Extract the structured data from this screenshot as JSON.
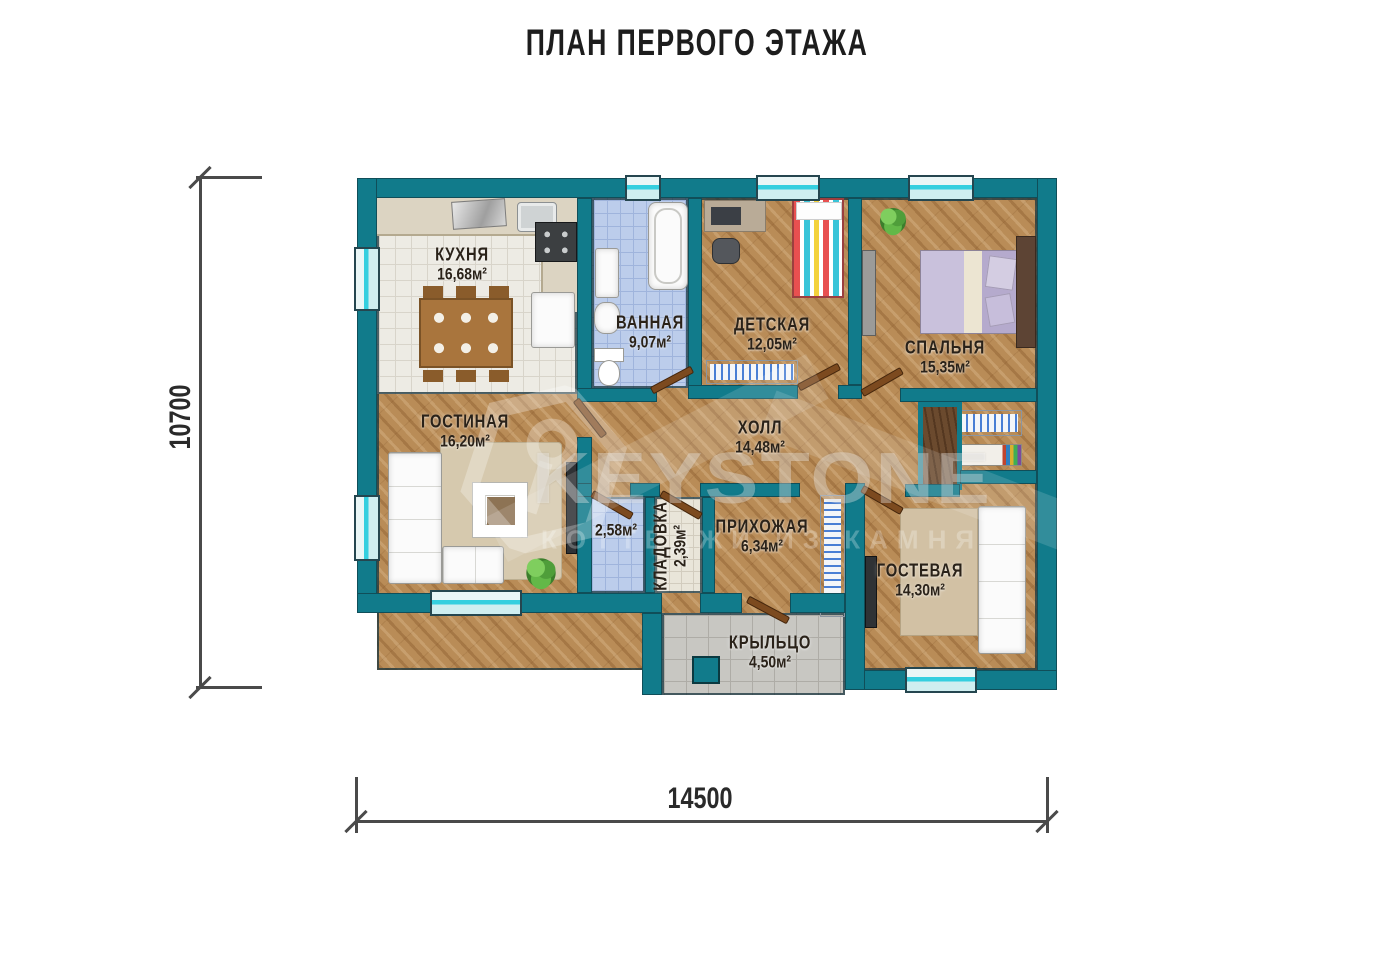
{
  "title": "ПЛАН ПЕРВОГО ЭТАЖА",
  "dimensions": {
    "height_label": "10700",
    "width_label": "14500"
  },
  "watermark": {
    "brand": "KEYSTONE",
    "tagline": "КОТТЕДЖИ ИЗ КАМНЯ"
  },
  "colors": {
    "wall_teal": "#117b8b",
    "window_cyan": "#35cfdf",
    "wood_floor": "#b98c57",
    "door_brown": "#7c4a1f"
  },
  "rooms": [
    {
      "key": "kitchen",
      "name": "КУХНЯ",
      "area": "16,68м²"
    },
    {
      "key": "bathroom",
      "name": "ВАННАЯ",
      "area": "9,07м²"
    },
    {
      "key": "nursery",
      "name": "ДЕТСКАЯ",
      "area": "12,05м²"
    },
    {
      "key": "bedroom",
      "name": "СПАЛЬНЯ",
      "area": "15,35м²"
    },
    {
      "key": "living",
      "name": "ГОСТИНАЯ",
      "area": "16,20м²"
    },
    {
      "key": "hall",
      "name": "ХОЛЛ",
      "area": "14,48м²"
    },
    {
      "key": "wc",
      "name": "",
      "area": "2,58м²"
    },
    {
      "key": "storage",
      "name": "КЛАДОВКА",
      "area": "2,39м²"
    },
    {
      "key": "hallway",
      "name": "ПРИХОЖАЯ",
      "area": "6,34м²"
    },
    {
      "key": "guest",
      "name": "ГОСТЕВАЯ",
      "area": "14,30м²"
    },
    {
      "key": "porch",
      "name": "КРЫЛЬЦО",
      "area": "4,50м²"
    }
  ]
}
